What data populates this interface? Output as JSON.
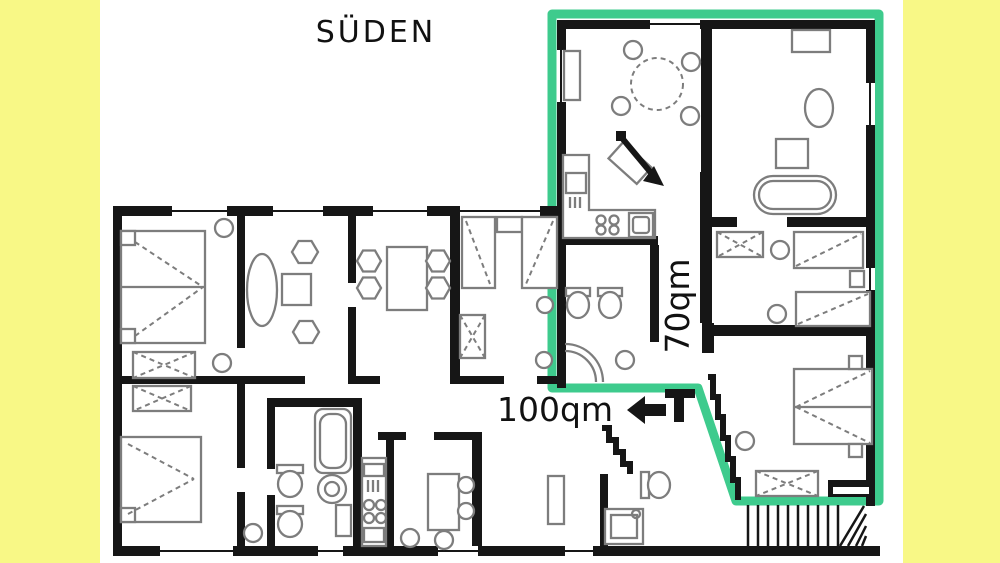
{
  "compass": {
    "label": "SÜDEN"
  },
  "areas": {
    "highlighted_apartment": "70qm",
    "other_apartment": "100qm"
  },
  "colors": {
    "background": "#ffffff",
    "side_bands": "#f8f886",
    "highlight": "#3ecb8d",
    "walls": "#161616",
    "furniture": "#7d7d7d",
    "text": "#111111"
  }
}
